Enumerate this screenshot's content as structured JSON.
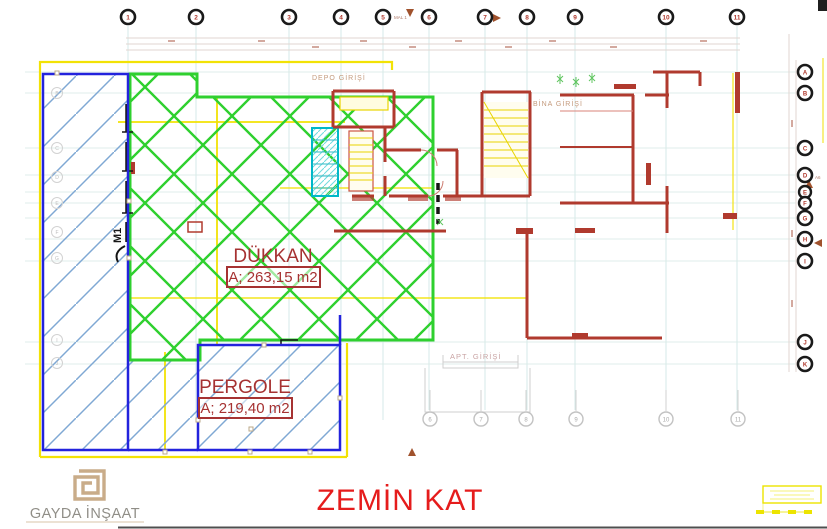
{
  "header": {
    "drawing_title": "ZEMİN KAT"
  },
  "company": {
    "name": "GAYDA İNŞAAT"
  },
  "rooms": {
    "dukkan": {
      "name": "DÜKKAN",
      "area": "A; 263,15 m2"
    },
    "pergole": {
      "name": "PERGOLE",
      "area": "A; 219,40 m2"
    }
  },
  "grid": {
    "top": [
      "1",
      "2",
      "3",
      "4",
      "5",
      "6",
      "7",
      "8",
      "9",
      "10",
      "11"
    ],
    "right": [
      "A",
      "B",
      "C",
      "D",
      "E",
      "F",
      "G",
      "H",
      "I",
      "J",
      "K"
    ],
    "bottom": [
      "6",
      "7",
      "8",
      "9",
      "10",
      "11"
    ],
    "left": [
      "B",
      "C",
      "D",
      "E",
      "F",
      "G",
      "I",
      "J"
    ]
  },
  "annotations": {
    "depo_girisi": "DEPO GİRİŞİ",
    "bina_girisi": "BİNA GİRİŞİ",
    "apt_girisi": "APT. GİRİŞİ",
    "mal1": "MAL 1",
    "a6": "A6",
    "m1": "M1"
  },
  "colors": {
    "wall_red": "#b03a2e",
    "hatch_green": "#2fd02f",
    "hatch_blue": "#7fa8d4",
    "border_blue": "#2323dd",
    "boundary_yellow": "#f2e205",
    "stair_cyan": "#00b8c8",
    "label_red": "#a63232",
    "title_red": "#e51c1c",
    "logo_tan": "#c9ac89"
  }
}
